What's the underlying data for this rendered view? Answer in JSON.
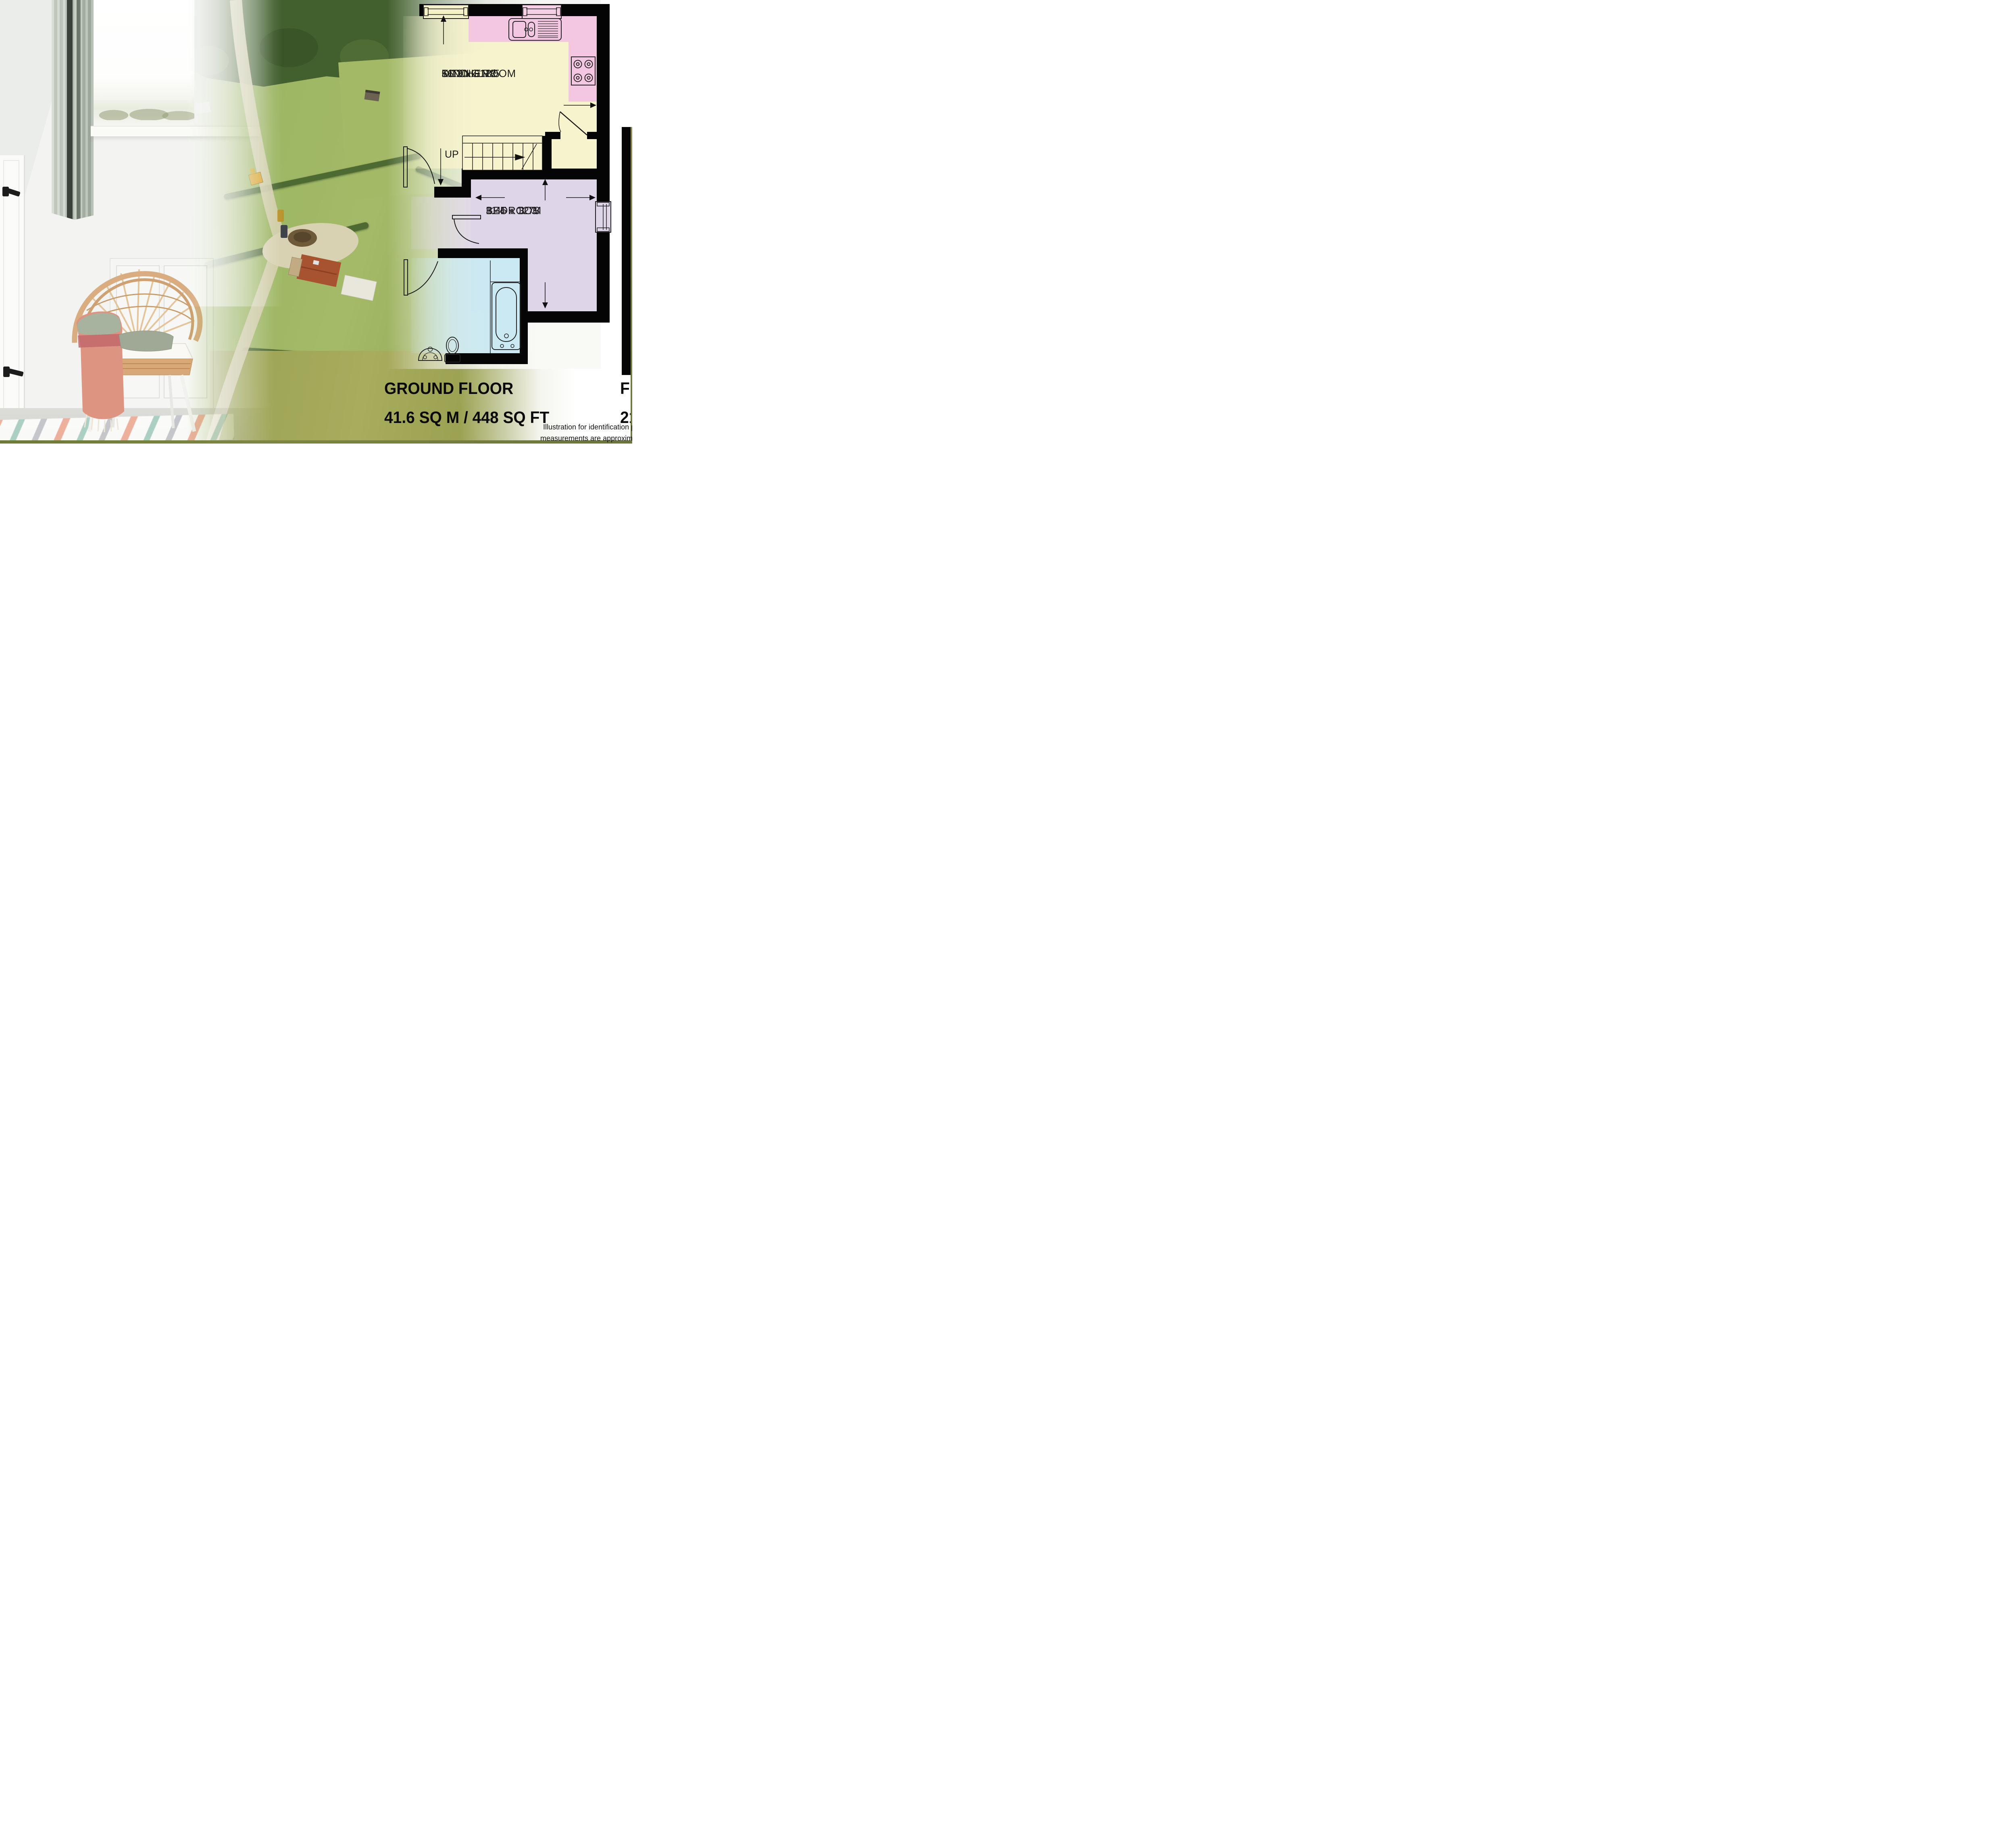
{
  "floorplan": {
    "title": "GROUND FLOOR",
    "area": "41.6 SQ M / 448 SQ FT",
    "stairs_label": "UP",
    "wall_color": "#050505",
    "counter_fill": "#f3c7e1",
    "rooms": [
      {
        "id": "kitchen-dining",
        "name_line1": "KITCHEN /",
        "name_line2": "DINING ROOM",
        "size_metric": "5.13 x 3.78",
        "size_imperial": "16'10 x 12'5",
        "fill": "#f7f3cc"
      },
      {
        "id": "bedroom",
        "name_line1": "BEDROOM",
        "size_metric": "3.45 x 3.73",
        "size_imperial": "11'4 x 12'3",
        "fill": "#dfd5e9"
      },
      {
        "id": "bathroom",
        "fill": "#cbe9f2"
      },
      {
        "id": "hall",
        "fill": "#f7f3cc"
      }
    ]
  },
  "next_floorplan_partial": {
    "title_visible": "FI",
    "area_visible": "21"
  },
  "disclaimer": {
    "line1_visible": "Illustration for identification p",
    "line2_visible": "measurements are approximat"
  }
}
